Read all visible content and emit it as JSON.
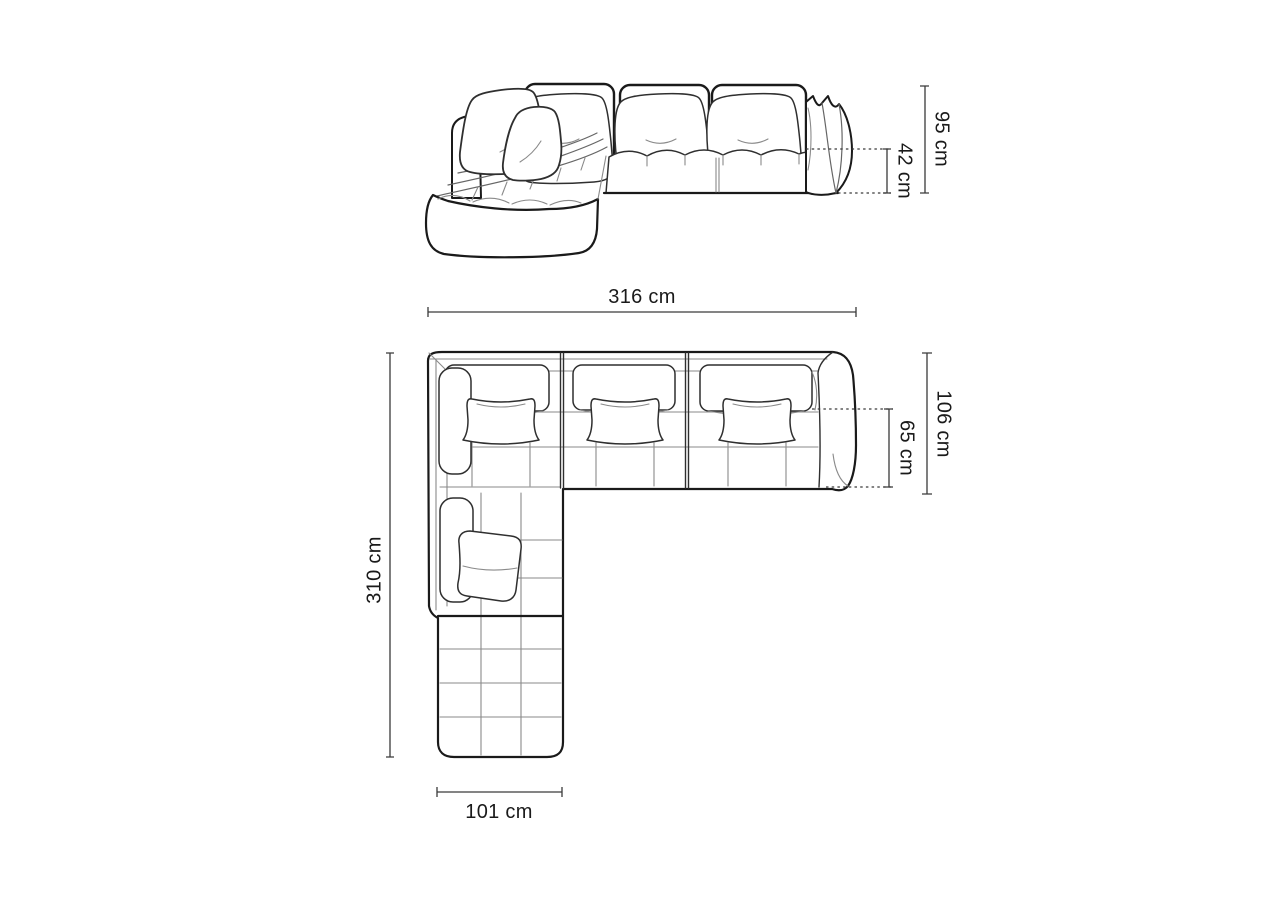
{
  "colors": {
    "background": "#ffffff",
    "line": "#1a1a1a",
    "mid": "#2f2f2f",
    "detail": "#8a8a8a",
    "dim": "#3a3a3a",
    "text": "#1a1a1a"
  },
  "dims": {
    "height_total": {
      "label": "95 cm",
      "value": 95,
      "unit": "cm"
    },
    "seat_height": {
      "label": "42 cm",
      "value": 42,
      "unit": "cm"
    },
    "width_total": {
      "label": "316 cm",
      "value": 316,
      "unit": "cm"
    },
    "depth_total": {
      "label": "310 cm",
      "value": 310,
      "unit": "cm"
    },
    "depth_body": {
      "label": "106 cm",
      "value": 106,
      "unit": "cm"
    },
    "depth_seat": {
      "label": "65 cm",
      "value": 65,
      "unit": "cm"
    },
    "chaise_width": {
      "label": "101 cm",
      "value": 101,
      "unit": "cm"
    }
  }
}
